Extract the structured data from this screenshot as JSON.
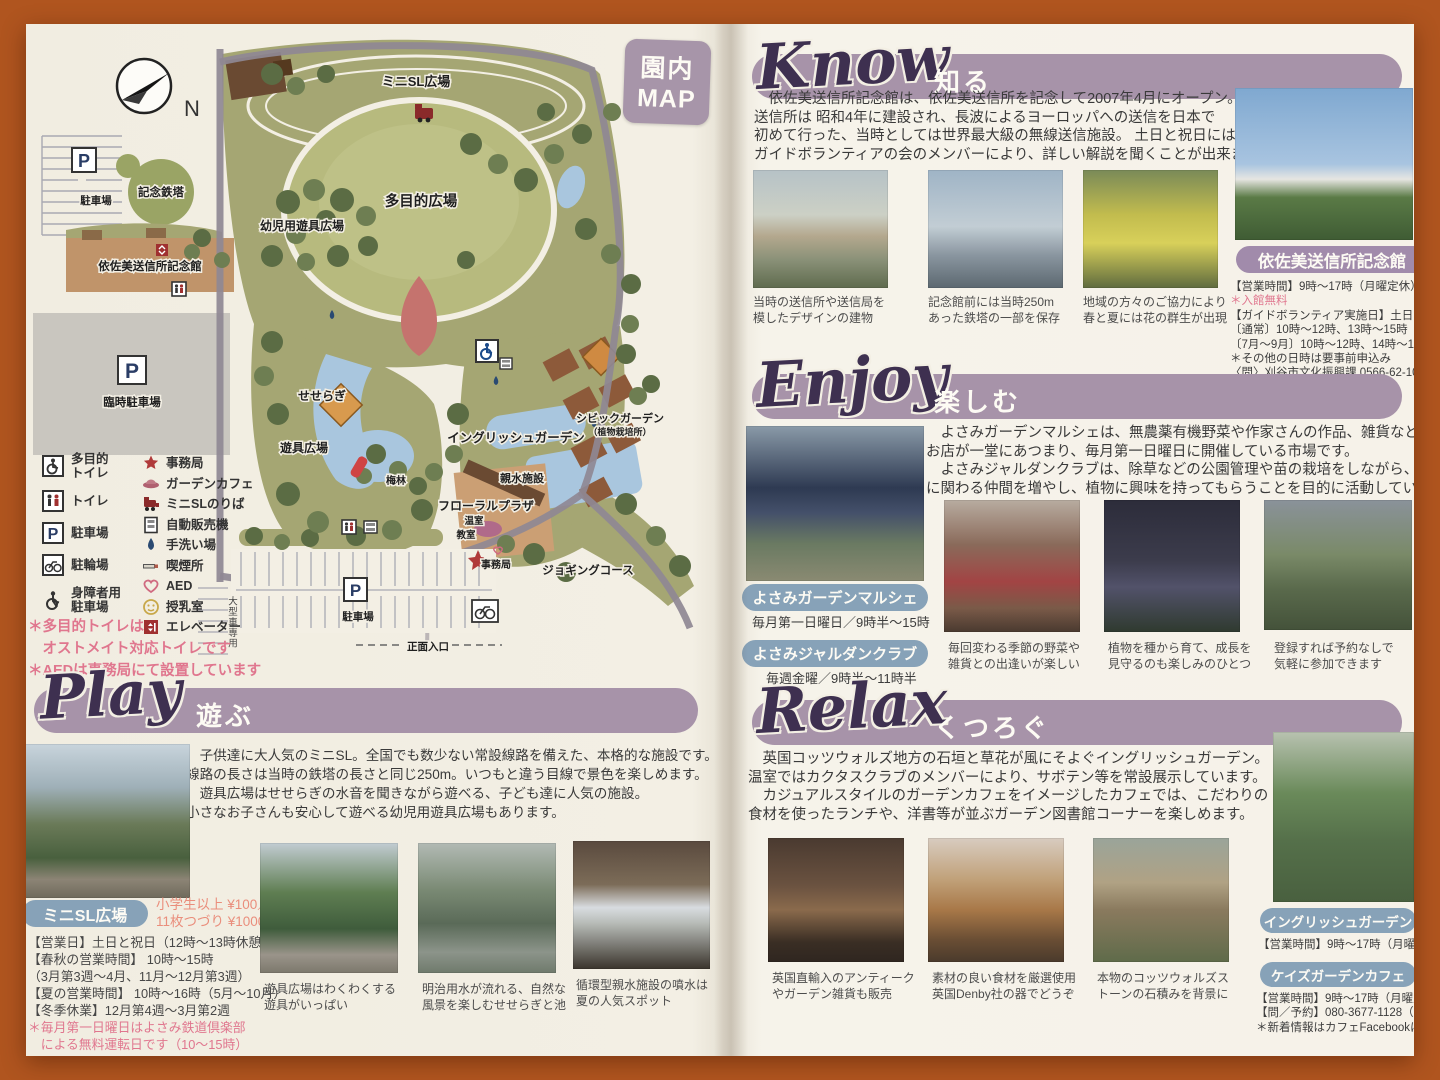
{
  "scene": {
    "north": "N",
    "badge_top": "園内",
    "badge_bottom": "MAP"
  },
  "map": {
    "labels": {
      "mini_sl_plaza": "ミニSL広場",
      "multipurpose_plaza": "多目的広場",
      "toddler_playground": "幼児用遊具広場",
      "memorial_tower": "記念鉄塔",
      "memorial_hall": "依佐美送信所記念館",
      "parking_nw": "駐車場",
      "temporary_parking": "臨時駐車場",
      "seseragi": "せせらぎ",
      "playground": "遊具広場",
      "plum_grove": "梅林",
      "english_garden": "イングリッシュガーデン",
      "floral_plaza": "フローラルプラザ",
      "greenhouse": "温室",
      "classroom": "教室",
      "office": "事務局",
      "water_facility": "親水施設",
      "civic_garden": "シビックガーデン",
      "civic_garden_note": "（植物栽培所）",
      "jogging_course": "ジョギングコース",
      "parking_south": "駐車場",
      "main_entrance": "正面入口",
      "large_vehicle_parking": "大型車専用"
    },
    "legend": {
      "left": [
        {
          "label": "多目的\nトイレ"
        },
        {
          "label": "トイレ"
        },
        {
          "label": "駐車場"
        },
        {
          "label": "駐輪場"
        },
        {
          "label": "身障者用\n駐車場"
        }
      ],
      "right": [
        {
          "label": "事務局"
        },
        {
          "label": "ガーデンカフェ"
        },
        {
          "label": "ミニSLのりば"
        },
        {
          "label": "自動販売機"
        },
        {
          "label": "手洗い場"
        },
        {
          "label": "喫煙所"
        },
        {
          "label": "AED"
        },
        {
          "label": "授乳室"
        },
        {
          "label": "エレベーター"
        }
      ],
      "notes": "＊多目的トイレは\n　オストメイト対応トイレです\n＊AEDは事務局にて設置しています"
    }
  },
  "know": {
    "title_en": "Know",
    "title_jp": "知る",
    "paragraph": [
      "　依佐美送信所記念館は、依佐美送信所を記念して2007年4月にオープン。",
      "送信所は 昭和4年に建設され、長波によるヨーロッパへの送信を日本で",
      "初めて行った、当時としては世界最大級の無線送信施設。 土日と祝日には",
      "ガイドボランティアの会のメンバーにより、詳しい解説を聞くことが出来ます。"
    ],
    "captions": [
      "当時の送信所や送信局を\n模したデザインの建物",
      "記念館前には当時250m\nあった鉄塔の一部を保存",
      "地域の方々のご協力により\n春と夏には花の群生が出現"
    ],
    "info": {
      "badge": "依佐美送信所記念館",
      "hours": "【営業時間】9時～17時（月曜定休）",
      "free": "＊入館無料",
      "guide": [
        "【ガイドボランティア実施日】土日と祝日",
        "〔通常〕10時～12時、13時～15時",
        "〔7月～9月〕10時～12時、14時～16時",
        "＊その他の日時は要事前申込み",
        "〈問〉刈谷市文化振興課 0566-62-1037"
      ]
    }
  },
  "enjoy": {
    "title_en": "Enjoy",
    "title_jp": "楽しむ",
    "paragraph": [
      "　よさみガーデンマルシェは、無農薬有機野菜や作家さんの作品、雑貨などの",
      "お店が一堂にあつまり、毎月第一日曜日に開催している市場です。",
      "　よさみジャルダンクラブは、除草などの公園管理や苗の栽培をしながら、公園",
      "に関わる仲間を増やし、植物に興味を持ってもらうことを目的に活動しています。"
    ],
    "marche_badge": "よさみガーデンマルシェ",
    "marche_schedule": "毎月第一日曜日／9時半～15時",
    "jardin_badge": "よさみジャルダンクラブ",
    "jardin_schedule": "毎週金曜／9時半～11時半",
    "captions": [
      "毎回変わる季節の野菜や\n雑貨との出逢いが楽しい",
      "植物を種から育て、成長を\n見守るのも楽しみのひとつ",
      "登録すれば予約なしで\n気軽に参加できます"
    ]
  },
  "relax": {
    "title_en": "Relax",
    "title_jp": "くつろぐ",
    "paragraph": [
      "　英国コッツウォルズ地方の石垣と草花が風にそよぐイングリッシュガーデン。",
      "温室ではカクタスクラブのメンバーにより、サボテン等を常設展示しています。",
      "　カジュアルスタイルのガーデンカフェをイメージしたカフェでは、こだわりの",
      "食材を使ったランチや、洋書等が並ぶガーデン図書館コーナーを楽しめます。"
    ],
    "captions": [
      "英国直輸入のアンティーク\nやガーデン雑貨も販売",
      "素材の良い食材を厳選使用\n英国Denby社の器でどうぞ",
      "本物のコッツウォルズス\nトーンの石積みを背景に"
    ],
    "garden_badge": "イングリッシュガーデン",
    "garden_hours": "【営業時間】9時～17時（月曜定休）",
    "cafe_badge": "ケイズガーデンカフェ",
    "cafe_lines": [
      "【営業時間】9時～17時（月曜定休）",
      "【問／予約】080-3677-1128（直通）",
      "＊新着情報はカフェFacebookにて"
    ]
  },
  "play": {
    "title_en": "Play",
    "title_jp": "遊ぶ",
    "paragraph": [
      "　子供達に大人気のミニSL。全国でも数少ない常設線路を備えた、本格的な施設です。",
      "線路の長さは当時の鉄塔の長さと同じ250m。いつもと違う目線で景色を楽しめます。",
      "　遊具広場はせせらぎの水音を聞きながら遊べる、子ども達に人気の施設。",
      "小さなお子さんも安心して遊べる幼児用遊具広場もあります。"
    ],
    "minisl": {
      "badge": "ミニSL広場",
      "price1": "小学生以上 ¥100／1回",
      "price2": "11枚つづり ¥1000 券あり",
      "schedule": [
        "【営業日】土日と祝日（12時～13時休憩）",
        "【春秋の営業時間】 10時～15時",
        "（3月第3週～4月、11月～12月第3週）",
        "【夏の営業時間】 10時～16時（5月～10月）",
        "【冬季休業】12月第4週～3月第2週"
      ],
      "notes": [
        "＊毎月第一日曜日はよさみ鉄道倶楽部",
        "　による無料運転日です（10～15時）"
      ]
    },
    "captions": [
      "遊具広場はわくわくする\n遊具がいっぱい",
      "明治用水が流れる、自然な\n風景を楽しむせせらぎと池",
      "循環型親水施設の噴水は\n夏の人気スポット"
    ]
  }
}
